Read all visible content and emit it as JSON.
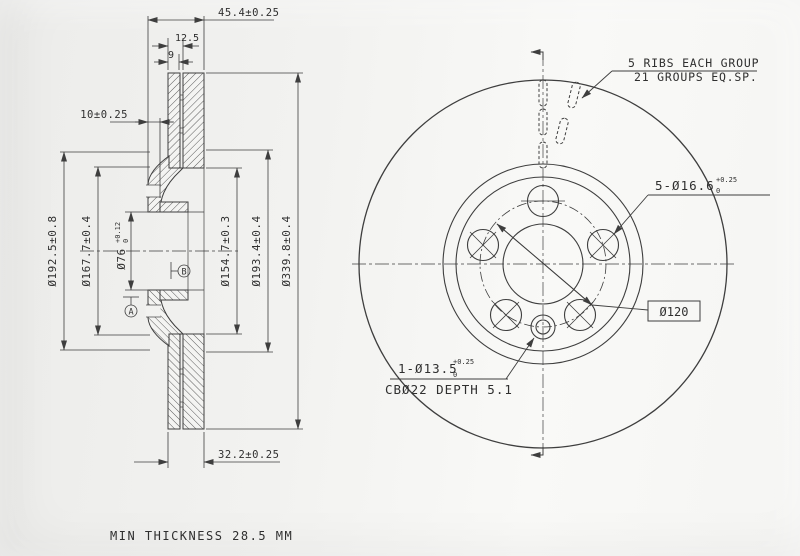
{
  "section": {
    "dims": {
      "overall_width": "45.4±0.25",
      "plate_gap_width": "12.5",
      "plate_thickness": "9",
      "hat_offset": "10±0.25",
      "hat_od": "Ø192.5±0.8",
      "flange_step_d": "Ø167.7±0.4",
      "bore": "Ø76",
      "bore_tol_up": "+0.12",
      "bore_tol_low": "0",
      "vent_inner_d": "Ø154.7±0.3",
      "hat_face_d": "Ø193.4±0.4",
      "outer_d": "Ø339.8±0.4",
      "ring_width": "32.2±0.25"
    },
    "datum_a": "A",
    "datum_b": "B"
  },
  "front": {
    "ribs_note1": "5 RIBS EACH GROUP",
    "ribs_note2": "21 GROUPS EQ.SP.",
    "bolt_holes": "5-Ø16.6",
    "bolt_tol_up": "+0.25",
    "bolt_tol_low": "0",
    "bolt_circle": "Ø120",
    "pin_hole": "1-Ø13.5",
    "pin_tol_up": "+0.25",
    "pin_tol_low": "0",
    "counterbore": "CBØ22 DEPTH 5.1"
  },
  "footer": {
    "min_thickness": "MIN THICKNESS 28.5 MM"
  },
  "colors": {
    "line": "#3e3e3e",
    "paper_left": "#ececea",
    "paper_right": "#f9f9f7"
  }
}
